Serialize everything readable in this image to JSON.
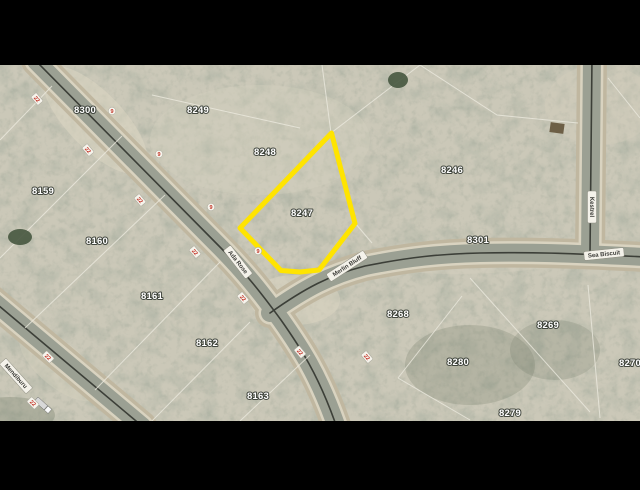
{
  "view": {
    "letterbox_color": "#000000",
    "kind": "aerial parcel map"
  },
  "map": {
    "highlight_color": "#ffe400",
    "selected_parcel": "8247",
    "parcels": [
      {
        "label": "8300"
      },
      {
        "label": "8249"
      },
      {
        "label": "8248"
      },
      {
        "label": "8247"
      },
      {
        "label": "8246"
      },
      {
        "label": "8159"
      },
      {
        "label": "8160"
      },
      {
        "label": "8161"
      },
      {
        "label": "8162"
      },
      {
        "label": "8163"
      },
      {
        "label": "8301"
      },
      {
        "label": "8268"
      },
      {
        "label": "8269"
      },
      {
        "label": "8280"
      },
      {
        "label": "8270"
      },
      {
        "label": "8279"
      }
    ],
    "streets": [
      {
        "name": "Ada Rose"
      },
      {
        "name": "Merlin Bluff"
      },
      {
        "name": "Sea Biscuit"
      },
      {
        "name": "Kestrel"
      },
      {
        "name": "Mendiburu"
      }
    ],
    "markers": {
      "lot_tick": "22",
      "point_tick": "9"
    }
  }
}
